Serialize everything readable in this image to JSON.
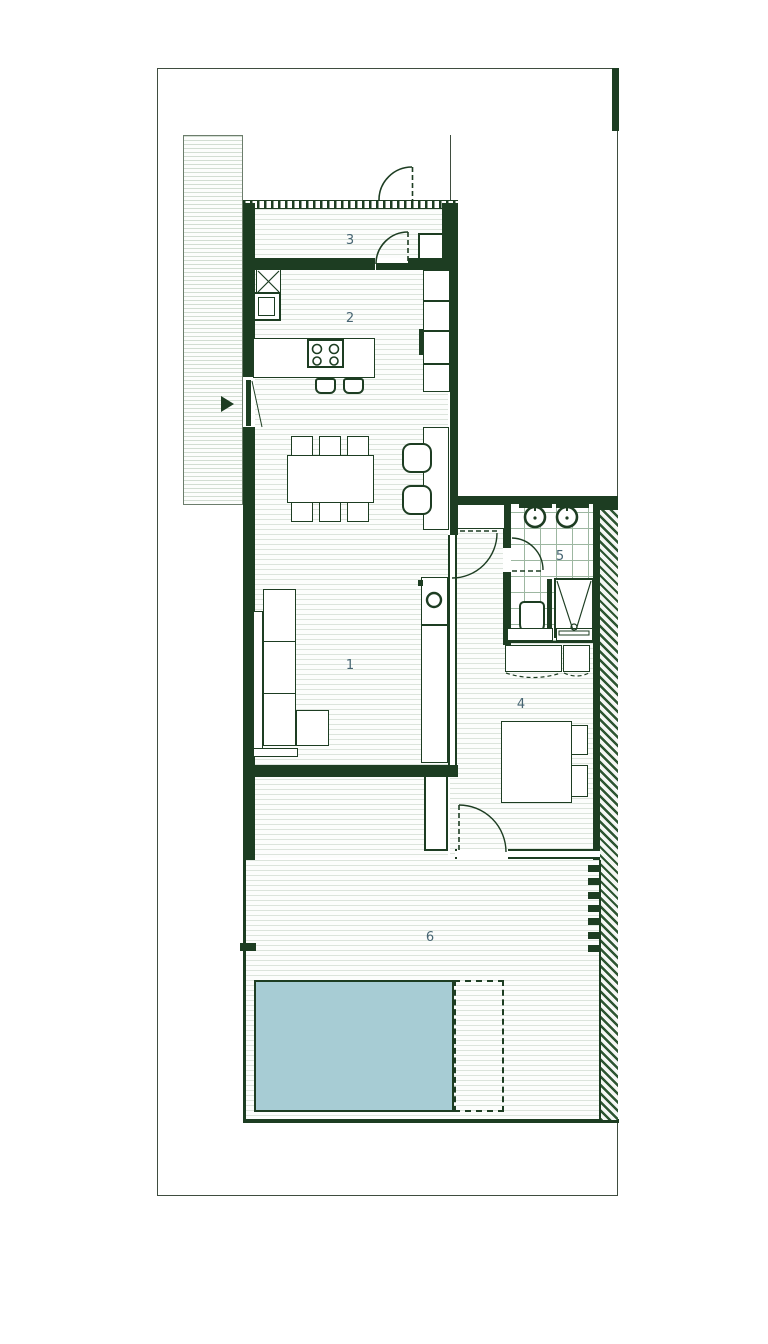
{
  "plan": {
    "type": "architectural-floor-plan",
    "colors": {
      "wall": "#1d3d22",
      "pool_water": "#a7ccd4",
      "floor_hatch_line": "#dce4dc",
      "diagonal_hatch": "#2c5531",
      "room_label": "#466472"
    },
    "rooms": [
      {
        "name": "living-room",
        "label": "1"
      },
      {
        "name": "kitchen",
        "label": "2"
      },
      {
        "name": "entry-porch",
        "label": "3"
      },
      {
        "name": "bedroom",
        "label": "4"
      },
      {
        "name": "bathroom",
        "label": "5"
      },
      {
        "name": "terrace",
        "label": "6"
      }
    ],
    "features": {
      "pool": "swimming-pool",
      "entrance_marker": "triangle-arrow",
      "bath_fixtures": [
        "washbasin",
        "washbasin",
        "toilet",
        "shower"
      ],
      "kitchen_fixtures": [
        "hob-4-burners",
        "sink",
        "boiler"
      ]
    }
  }
}
